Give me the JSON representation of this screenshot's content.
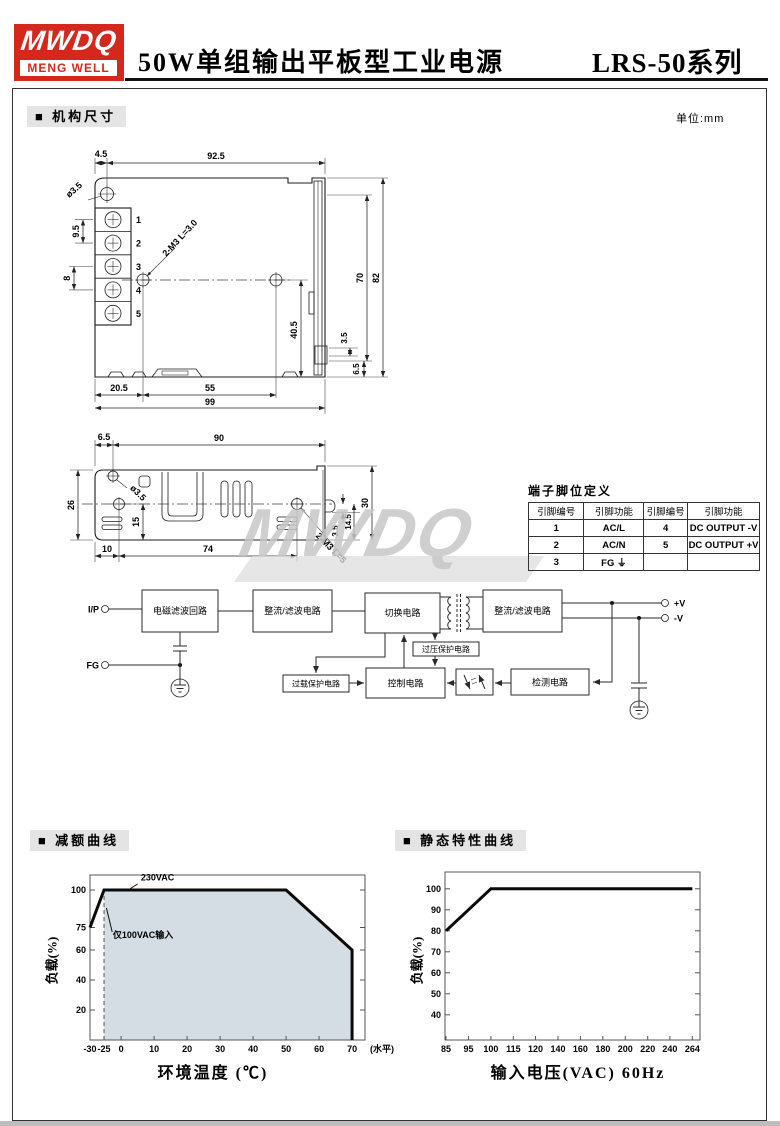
{
  "header": {
    "logo_line1": "MWDQ",
    "logo_line2": "MENG WELL",
    "title": "50W单组输出平板型工业电源",
    "series": "LRS-50系列",
    "accent_color": "#d4281c"
  },
  "section_mech": {
    "label": "■ 机构尺寸",
    "unit": "单位:mm"
  },
  "watermark": "MWDQ",
  "drawing_front": {
    "top45": "4.5",
    "top925": "92.5",
    "dia": "ø3.5",
    "pitch95": "9.5",
    "pitch8": "8",
    "tap": "2-M3 L=3.0",
    "h405": "40.5",
    "h70": "70",
    "h82": "82",
    "s35": "3.5",
    "s65": "6.5",
    "b205": "20.5",
    "b55": "55",
    "b99": "99",
    "pins": [
      "1",
      "2",
      "3",
      "4",
      "5"
    ]
  },
  "drawing_top": {
    "t65": "6.5",
    "t90": "90",
    "h26": "26",
    "dia": "ø3.5",
    "v15": "15",
    "b10": "10",
    "b74": "74",
    "r35": "3.5",
    "r145": "14.5",
    "r30": "30",
    "tap": "2-M3 L=5"
  },
  "pin_table": {
    "title": "端子脚位定义",
    "headers": [
      "引脚编号",
      "引脚功能",
      "引脚编号",
      "引脚功能"
    ],
    "rows": [
      [
        "1",
        "AC/L",
        "4",
        "DC OUTPUT -V"
      ],
      [
        "2",
        "AC/N",
        "5",
        "DC OUTPUT +V"
      ],
      [
        "3",
        "FG ⏚",
        "",
        ""
      ]
    ]
  },
  "block_diagram": {
    "ip": "I/P",
    "fg": "FG",
    "emi": "电磁滤波回路",
    "rect1": "整流/滤波电路",
    "sw": "切换电路",
    "rect2": "整流/滤波电路",
    "ovp": "过压保护电路",
    "olp": "过载保护电路",
    "ctrl": "控制电路",
    "det": "检测电路",
    "vpos": "+V",
    "vneg": "-V"
  },
  "section_derating": {
    "label": "■ 减额曲线"
  },
  "section_static": {
    "label": "■ 静态特性曲线"
  },
  "chart_data": [
    {
      "id": "derating-curve",
      "type": "line",
      "title": "减额曲线",
      "xlabel": "环境温度 (℃)",
      "ylabel": "负载(%)",
      "x_ticks": [
        {
          "label": "-30",
          "v": -30,
          "f": 0
        },
        {
          "label": "-25",
          "v": -25,
          "f": 0.051
        },
        {
          "label": "0",
          "v": 0,
          "f": 0.113
        },
        {
          "label": "10",
          "v": 10,
          "f": 0.233
        },
        {
          "label": "20",
          "v": 20,
          "f": 0.353
        },
        {
          "label": "30",
          "v": 30,
          "f": 0.473
        },
        {
          "label": "40",
          "v": 40,
          "f": 0.593
        },
        {
          "label": "50",
          "v": 50,
          "f": 0.713
        },
        {
          "label": "60",
          "v": 60,
          "f": 0.833
        },
        {
          "label": "70",
          "v": 70,
          "f": 0.953
        }
      ],
      "x_suffix_label": "(水平)",
      "y_ticks": [
        20,
        40,
        60,
        75,
        100
      ],
      "ylim": [
        0,
        110
      ],
      "grid": false,
      "legend": "none",
      "series": [
        {
          "name": "load-limit",
          "points": [
            [
              -30,
              75
            ],
            [
              -25,
              100
            ],
            [
              50,
              100
            ],
            [
              70,
              60
            ],
            [
              70,
              0
            ]
          ]
        }
      ],
      "fill": {
        "points": [
          [
            -25,
            100
          ],
          [
            50,
            100
          ],
          [
            70,
            60
          ],
          [
            70,
            0
          ],
          [
            -25,
            0
          ]
        ],
        "color": "#d4dde3"
      },
      "vline": {
        "x": -25,
        "y0": 0,
        "y1": 100
      },
      "annotations": [
        {
          "text": "230VAC",
          "tx": 6,
          "ty": 106.5,
          "lx1": 5,
          "ly1": 104,
          "lx2": 2.5,
          "ly2": 100.5
        },
        {
          "text": "仅100VAC输入",
          "tx": -12,
          "ty": 68,
          "lx1": -13,
          "ly1": 72,
          "lx2": -21.5,
          "ly2": 88
        }
      ]
    },
    {
      "id": "static-characteristic",
      "type": "line",
      "title": "静态特性曲线",
      "xlabel": "输入电压(VAC) 60Hz",
      "ylabel": "负载(%)",
      "x_ticks": [
        {
          "label": "85",
          "v": 85,
          "f": 0.004
        },
        {
          "label": "95",
          "v": 95,
          "f": 0.092
        },
        {
          "label": "100",
          "v": 100,
          "f": 0.18
        },
        {
          "label": "115",
          "v": 115,
          "f": 0.268
        },
        {
          "label": "120",
          "v": 120,
          "f": 0.355
        },
        {
          "label": "140",
          "v": 140,
          "f": 0.443
        },
        {
          "label": "160",
          "v": 160,
          "f": 0.531
        },
        {
          "label": "180",
          "v": 180,
          "f": 0.619
        },
        {
          "label": "200",
          "v": 200,
          "f": 0.707
        },
        {
          "label": "220",
          "v": 220,
          "f": 0.795
        },
        {
          "label": "240",
          "v": 240,
          "f": 0.882
        },
        {
          "label": "264",
          "v": 264,
          "f": 0.97
        }
      ],
      "y_ticks": [
        40,
        50,
        60,
        70,
        80,
        90,
        100
      ],
      "ylim": [
        28,
        108
      ],
      "grid": false,
      "legend": "none",
      "series": [
        {
          "name": "load-vs-input-voltage",
          "points": [
            [
              85,
              80
            ],
            [
              100,
              100
            ],
            [
              264,
              100
            ]
          ]
        }
      ]
    }
  ]
}
